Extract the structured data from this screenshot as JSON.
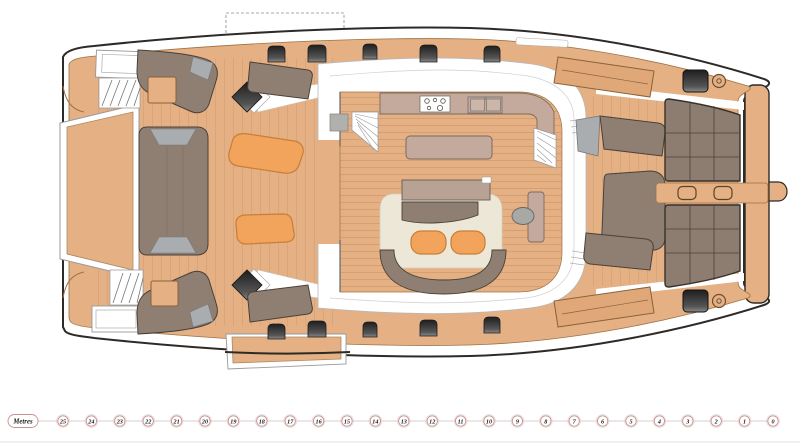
{
  "plan": {
    "type": "catamaran-deck-plan",
    "orientation": "bow-right"
  },
  "palette": {
    "background": "#ffffff",
    "outline": "#2e2a26",
    "deck": "#e4b084",
    "deck_line": "#9c7344",
    "white": "#ffffff",
    "furniture": "#8f7f73",
    "furniture_dark": "#4a4038",
    "furniture_light": "#b8a294",
    "cushion_gray": "#a9adb0",
    "pad_orange": "#f2a45c",
    "pad_orange_line": "#c87e36",
    "counter": "#c3aa9d",
    "counter_line": "#7d6a5e",
    "rug": "#ede7d8",
    "trampoline": "#8d7d70",
    "trampoline_line": "#4a4138",
    "scale_ring": "#c98f8f",
    "scale_halo": "#e7d8d8",
    "scale_line": "#d8cccc",
    "scale_text": "#1a1a1a"
  },
  "scale": {
    "label": "Metres",
    "ticks": [
      25,
      24,
      23,
      22,
      21,
      20,
      19,
      18,
      17,
      16,
      15,
      14,
      13,
      12,
      11,
      10,
      9,
      8,
      7,
      6,
      5,
      4,
      3,
      2,
      1,
      0
    ],
    "metre_px": 28.4,
    "x_right": 773,
    "y": 421,
    "radius": 5.2,
    "line_start_x": 38
  }
}
